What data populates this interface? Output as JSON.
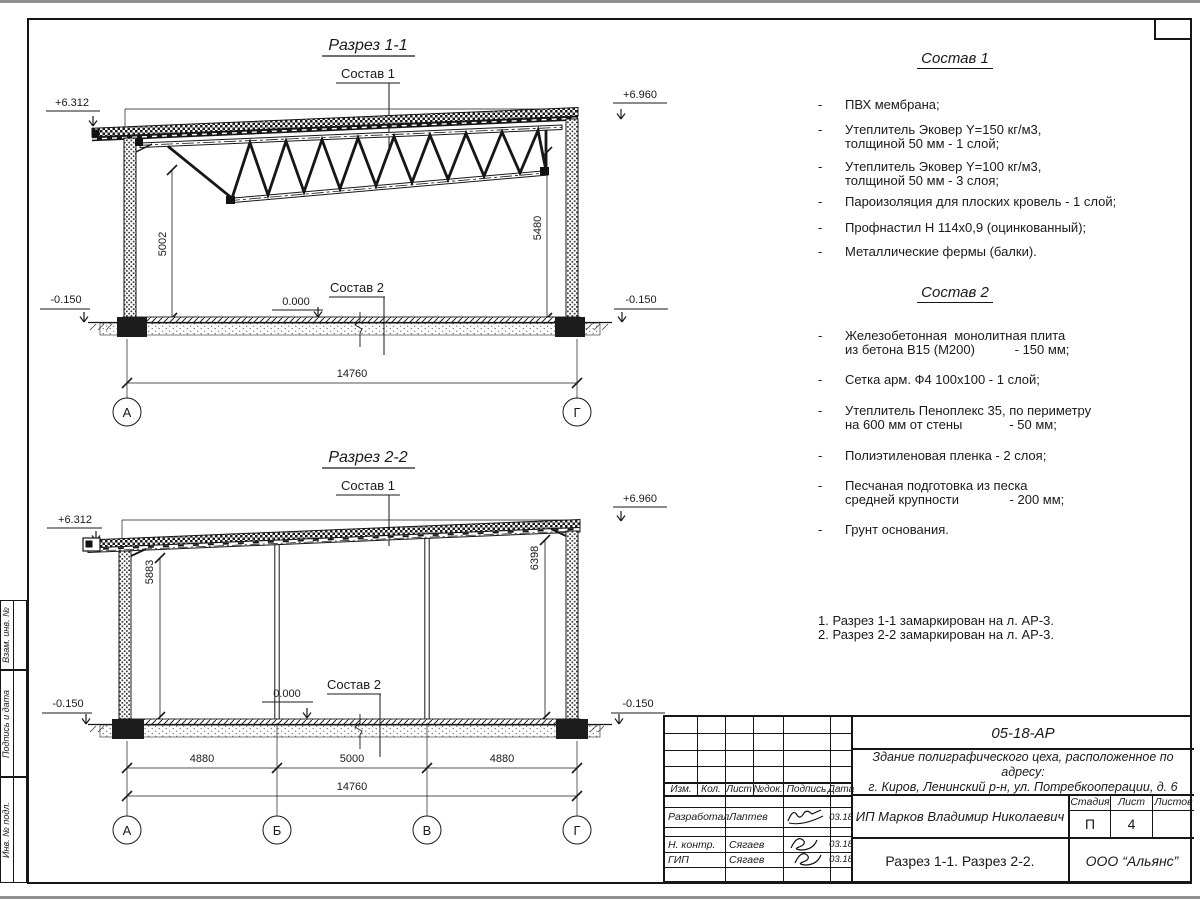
{
  "frame": {
    "margin_labels": [
      "Взам. инв. №",
      "Подпись и дата",
      "Инв. № подл."
    ]
  },
  "section1": {
    "title": "Разрез 1-1",
    "callout_roof": "Состав 1",
    "callout_floor": "Состав 2",
    "level_left": "+6.312",
    "level_right": "+6.960",
    "level_zero": "0.000",
    "level_minus_left": "-0.150",
    "level_minus_right": "-0.150",
    "dim_height_left": "5002",
    "dim_height_right": "5480",
    "dim_total": "14760",
    "axis_a": "А",
    "axis_g": "Г"
  },
  "section2": {
    "title": "Разрез 2-2",
    "callout_roof": "Состав 1",
    "callout_floor": "Состав 2",
    "level_left": "+6.312",
    "level_right": "+6.960",
    "level_zero": "0.000",
    "level_minus_left": "-0.150",
    "level_minus_right": "-0.150",
    "dim_height_left": "5883",
    "dim_height_right": "6398",
    "dim_span1": "4880",
    "dim_span2": "5000",
    "dim_span3": "4880",
    "dim_total": "14760",
    "axis_a": "А",
    "axis_b": "Б",
    "axis_v": "В",
    "axis_g": "Г"
  },
  "sostav1": {
    "title": "Состав 1",
    "items": [
      "ПВХ мембрана;",
      "Утеплитель Эковер Y=150 кг/м3,\nтолщиной 50 мм - 1 слой;",
      "Утеплитель Эковер Y=100 кг/м3,\nтолщиной 50 мм - 3 слоя;",
      "Пароизоляция для плоских кровель - 1 слой;",
      "Профнастил Н 114х0,9 (оцинкованный);",
      "Металлические фермы (балки)."
    ]
  },
  "sostav2": {
    "title": "Состав 2",
    "items": [
      "Железобетонная  монолитная плита\nиз бетона В15 (М200)           - 150 мм;",
      "Сетка арм. Ф4 100х100 - 1 слой;",
      "Утеплитель Пеноплекс 35, по периметру\nна 600 мм от стены             - 50 мм;",
      "Полиэтиленовая пленка - 2 слоя;",
      "Песчаная подготовка из песка\nсредней крупности              - 200 мм;",
      "Грунт основания."
    ]
  },
  "notes": [
    "1. Разрез 1-1 замаркирован на л. АР-3.",
    "2. Разрез 2-2 замаркирован на л. АР-3."
  ],
  "titleblock": {
    "doc_number": "05-18-АР",
    "project": "Здание полиграфического цеха, расположенное по адресу:\nг. Киров,  Ленинский р-н, ул. Потребкооперации, д. 6",
    "client": "ИП Марков Владимир Николаевич",
    "sheet_name": "Разрез 1-1. Разрез 2-2.",
    "company": "ООО “Альянс”",
    "col_izm": "Изм.",
    "col_kol": "Кол.",
    "col_list": "Лист",
    "col_ndok": "№док.",
    "col_podpis": "Подпись",
    "col_data": "Дата",
    "stage_label": "Стадия",
    "sheet_label": "Лист",
    "sheets_label": "Листов",
    "stage": "П",
    "sheet_no": "4",
    "sheets_total": "",
    "row_dev_role": "Разработал",
    "row_dev_name": "Лаптев",
    "row_dev_date": "03.18",
    "row_nk_role": "Н. контр.",
    "row_nk_name": "Сягаев",
    "row_nk_date": "03.18",
    "row_gip_role": "ГИП",
    "row_gip_name": "Сягаев",
    "row_gip_date": "03.18"
  }
}
